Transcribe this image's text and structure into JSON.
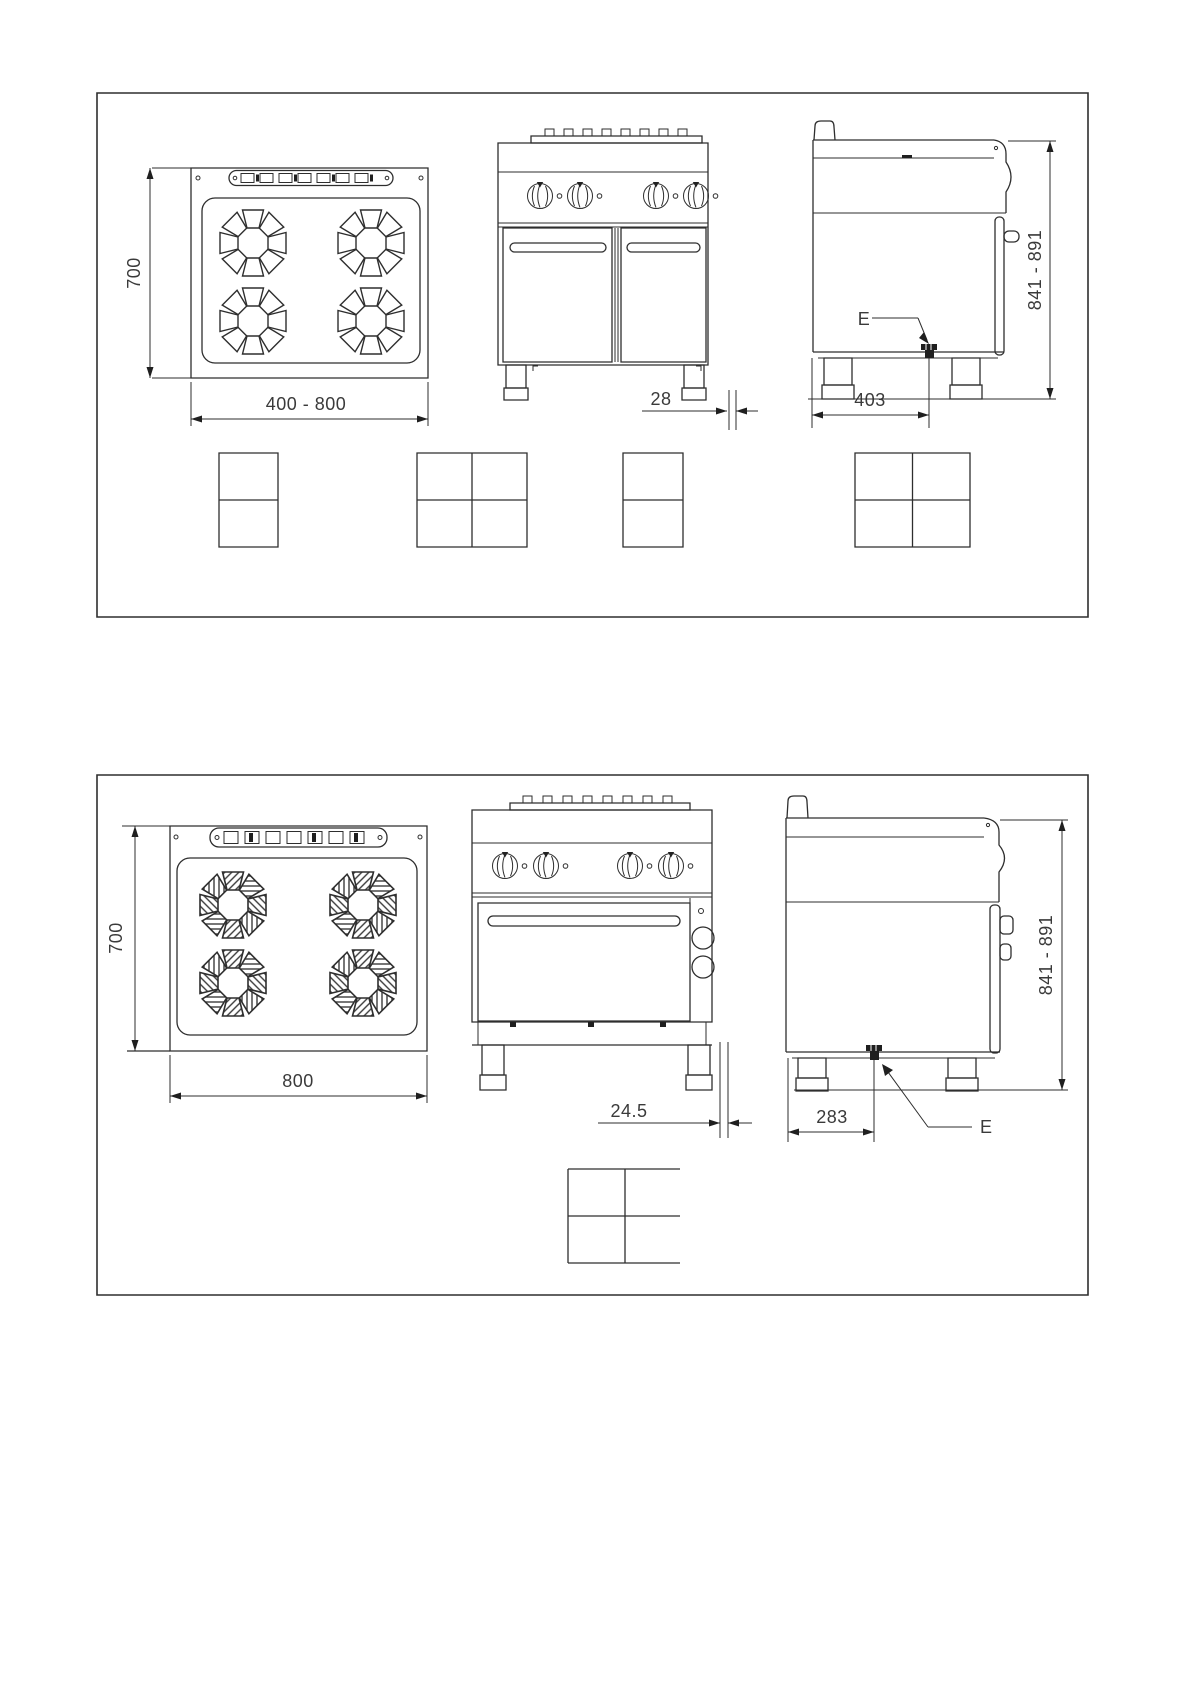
{
  "panel_top": {
    "plan": {
      "depth_label": "700",
      "width_label": "400 - 800"
    },
    "front": {
      "gap_label": "28"
    },
    "side": {
      "height_label": "841 - 891",
      "depth_to_connection_label": "403",
      "connection_label": "E"
    }
  },
  "panel_bottom": {
    "plan": {
      "depth_label": "700",
      "width_label": "800"
    },
    "front": {
      "gap_label": "24.5"
    },
    "side": {
      "height_label": "841 - 891",
      "depth_to_connection_label": "283",
      "connection_label": "E"
    }
  }
}
